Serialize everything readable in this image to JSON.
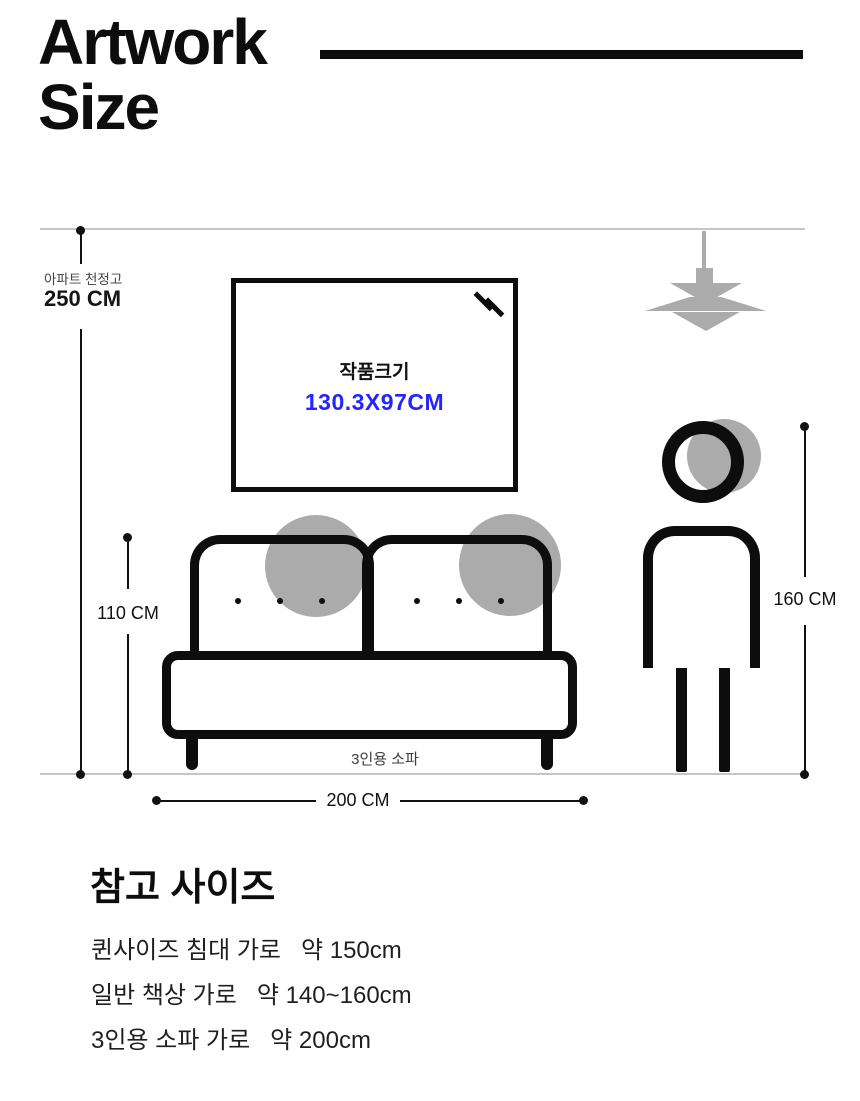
{
  "header": {
    "title_line1": "Artwork",
    "title_line2": "Size"
  },
  "diagram": {
    "ceiling": {
      "label": "아파트 천정고",
      "value": "250 CM"
    },
    "artwork": {
      "label": "작품크기",
      "size": "130.3X97CM"
    },
    "sofa": {
      "label": "3인용 소파",
      "height": "110 CM",
      "width": "200 CM"
    },
    "person": {
      "height": "160 CM"
    },
    "icons": [
      "pendant-lamp-icon",
      "person-figure",
      "frame-glare-icon"
    ]
  },
  "reference": {
    "heading": "참고 사이즈",
    "items": [
      "퀸사이즈 침대 가로   약 150cm",
      "일반 책상 가로   약 140~160cm",
      "3인용 소파 가로   약 200cm"
    ]
  },
  "colors": {
    "accent_blue": "#2424ff",
    "shape_gray": "#ababab",
    "guide_gray": "#c5c5c5",
    "ink": "#0d0d0d"
  }
}
